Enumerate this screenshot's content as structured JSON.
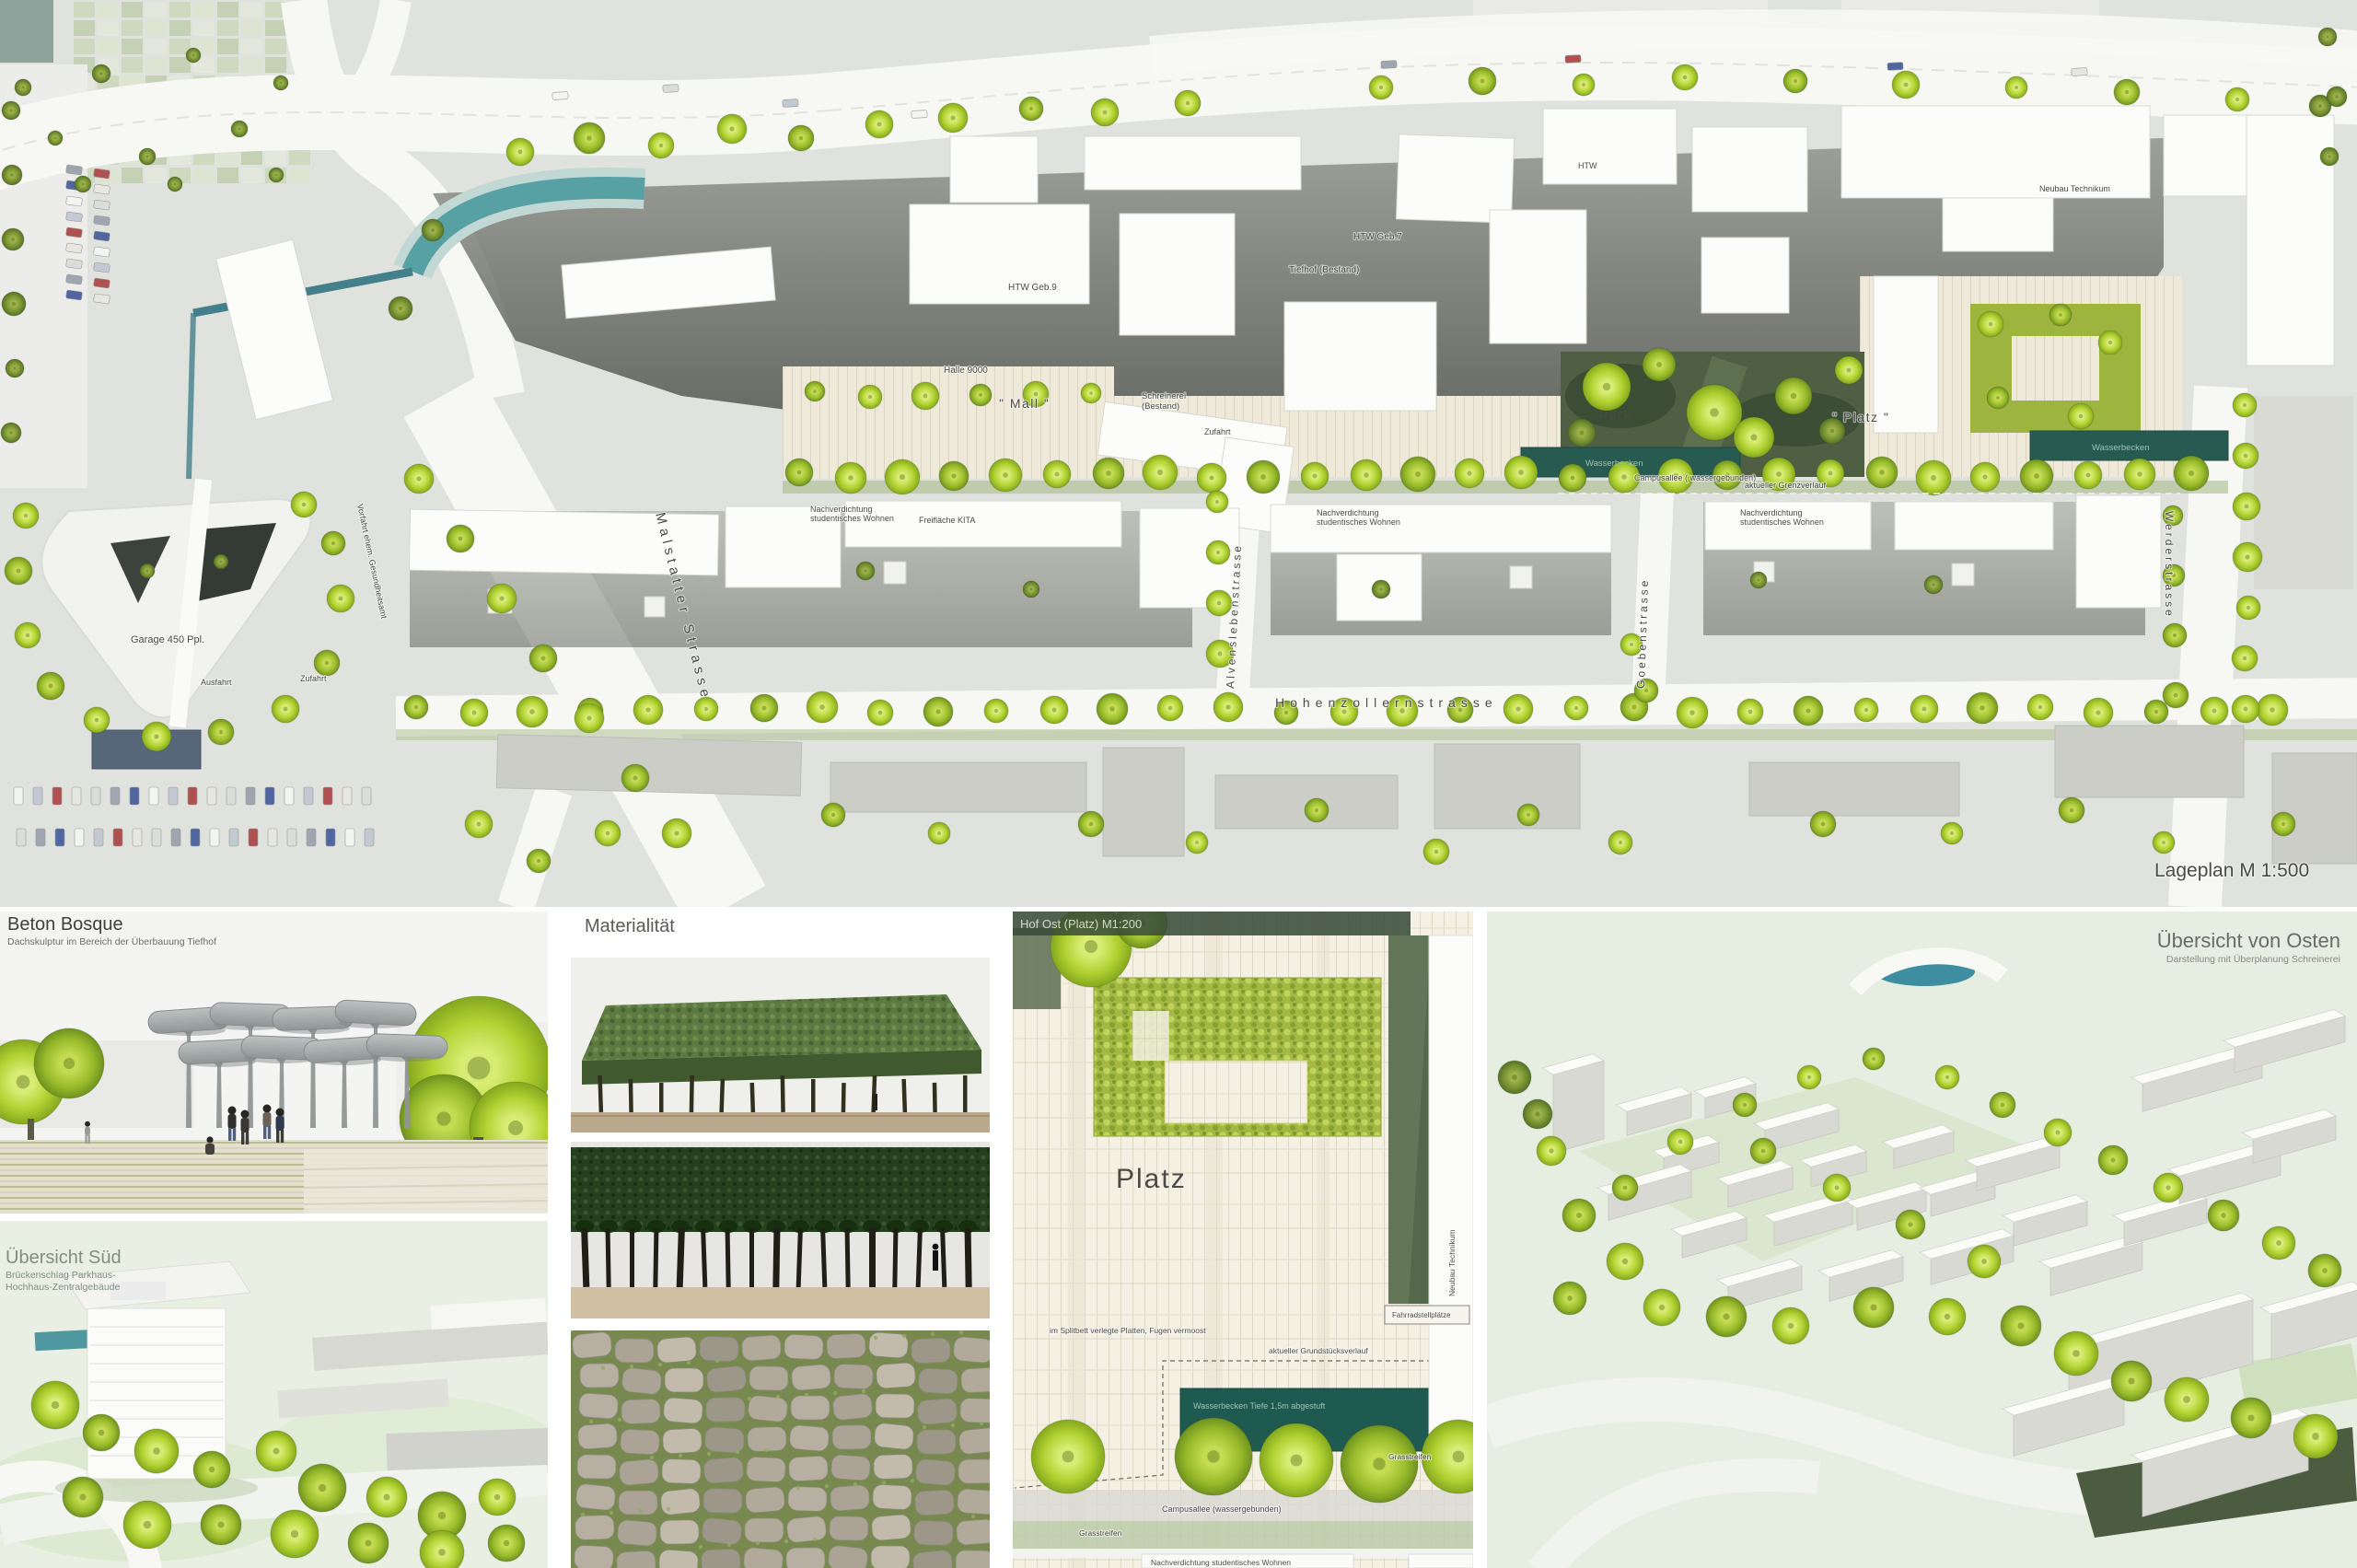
{
  "site_plan": {
    "scale_label": "Lageplan M 1:500",
    "streets": {
      "malstatter": "Malstatter Strasse",
      "hohenzollern": "Hohenzollernstrasse",
      "alvensleben": "Alvenslebenstrasse",
      "goeben": "Goebenstrasse",
      "werder": "Werderstrasse"
    },
    "labels": {
      "garage": "Garage 450 Ppl.",
      "ausfahrt": "Ausfahrt",
      "zufahrt": "Zufahrt",
      "vorfahrt": "Vorfahrt ehem. Gesundheitsamt",
      "tiefhof": "Tiefhof (Bestand)",
      "htw_geb7": "HTW Geb.7",
      "htw_geb9": "HTW Geb.9",
      "halle9000": "Halle 9000",
      "mall": "\" Mall \"",
      "schreinerei_l1": "Schreinerei",
      "schreinerei_l2": "(Bestand)",
      "park": "\" Park \"",
      "platz": "\" Platz \"",
      "wasserbecken": "Wasserbecken",
      "campusallee": "Campusallee ( wassergebunden)",
      "grenzverlauf": "aktueller Grenzverlauf",
      "nachverdichtung_l1": "Nachverdichtung",
      "nachverdichtung_l2": "studentisches Wohnen",
      "freiflaeche_kita": "Freifläche KITA",
      "htw": "HTW",
      "neubau_technikum": "Neubau Technikum"
    }
  },
  "panels": {
    "beton_bosque": {
      "title": "Beton Bosque",
      "subtitle": "Dachskulptur im Bereich der Überbauung Tiefhof"
    },
    "uebersicht_sued": {
      "title": "Übersicht Süd",
      "subtitle_l1": "Brückenschlag Parkhaus-",
      "subtitle_l2": "Hochhaus-Zentralgebäude"
    },
    "materialitaet": {
      "title": "Materialität"
    },
    "hof_ost": {
      "title": "Hof Ost (Platz) M1:200",
      "platz": "Platz",
      "splitbett": "im Splitbett verlegte Platten, Fugen vermoost",
      "grundstueck": "aktueller Grundstücksverlauf",
      "wasserbecken": "Wasserbecken Tiefe 1,5m abgestuft",
      "fahrrad": "Fahrradstellplätze",
      "grasstreifen": "Grasstreifen",
      "campusallee": "Campusallee (wassergebunden)",
      "nachverdichtung": "Nachverdichtung studentisches Wohnen",
      "neubau_technikum": "Neubau Technikum"
    },
    "uebersicht_osten": {
      "title": "Übersicht von Osten",
      "subtitle": "Darstellung mit Überplanung Schreinerei"
    }
  },
  "colors": {
    "tree_green": "#b9d838",
    "hedge_green": "#4e5f44",
    "water_teal": "#2c6057",
    "paving_beige": "#efe9d9",
    "lawn_green": "#e7efe2"
  }
}
